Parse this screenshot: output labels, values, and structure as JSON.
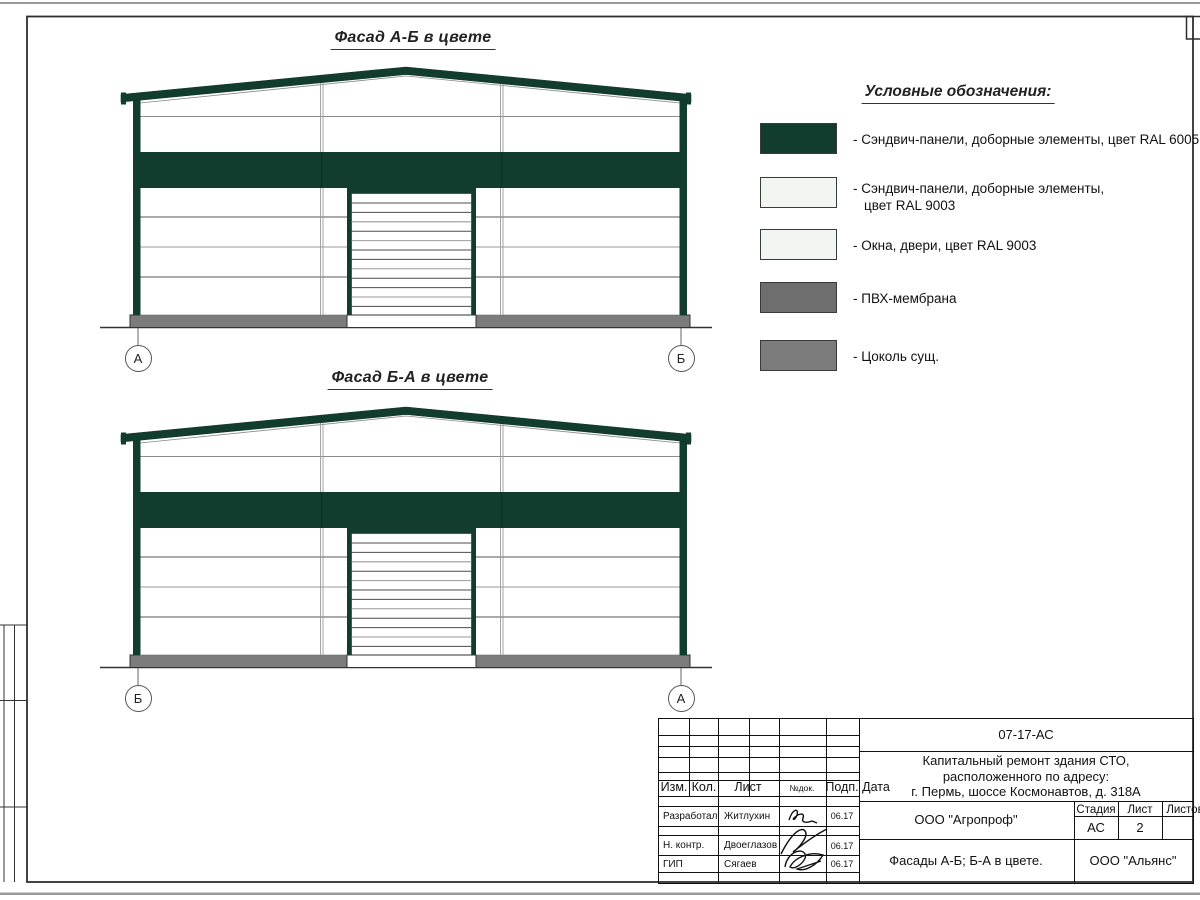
{
  "colors": {
    "green": "#123D2E",
    "offwhite": "#F1F6F2",
    "pvc": "#6E6E6E",
    "plinth": "#7C7C7C"
  },
  "facade1": {
    "title": "Фасад А-Б в цвете",
    "marker_left": "А",
    "marker_right": "Б"
  },
  "facade2": {
    "title": "Фасад Б-А в цвете",
    "marker_left": "Б",
    "marker_right": "А"
  },
  "legend": {
    "title": "Условные обозначения:",
    "items": [
      {
        "line1": "- Сэндвич-панели, доборные элементы,  цвет RAL 6005",
        "line2": ""
      },
      {
        "line1": "- Сэндвич-панели, доборные элементы,",
        "line2": "цвет RAL 9003"
      },
      {
        "line1": "- Окна, двери, цвет RAL 9003",
        "line2": ""
      },
      {
        "line1": "- ПВХ-мембрана",
        "line2": ""
      },
      {
        "line1": "- Цоколь сущ.",
        "line2": ""
      }
    ]
  },
  "titleblock": {
    "doc_code": "07-17-АС",
    "project_line1": "Капитальный ремонт здания СТО,",
    "project_line2": "расположенного по адресу:",
    "project_line3": "г. Пермь, шоссе Космонавтов, д. 318А",
    "col_izm": "Изм.",
    "col_kol": "Кол.",
    "col_list": "Лист",
    "col_ndoc": "№док.",
    "col_podp": "Подп.",
    "col_data": "Дата",
    "stage_header": "Стадия",
    "sheet_header": "Лист",
    "sheets_header": "Листов",
    "stage_value": "АС",
    "sheet_value": "2",
    "org": "ООО \"Агропроф\"",
    "sheet_title": "Фасады А-Б; Б-А в цвете.",
    "firm": "ООО \"Альянс\"",
    "rows": [
      {
        "role": "Разработал",
        "name": "Житлухин",
        "date": "06.17"
      },
      {
        "role": "Н. контр.",
        "name": "Двоеглазов",
        "date": "06.17"
      },
      {
        "role": "ГИП",
        "name": "Сягаев",
        "date": "06.17"
      }
    ]
  }
}
